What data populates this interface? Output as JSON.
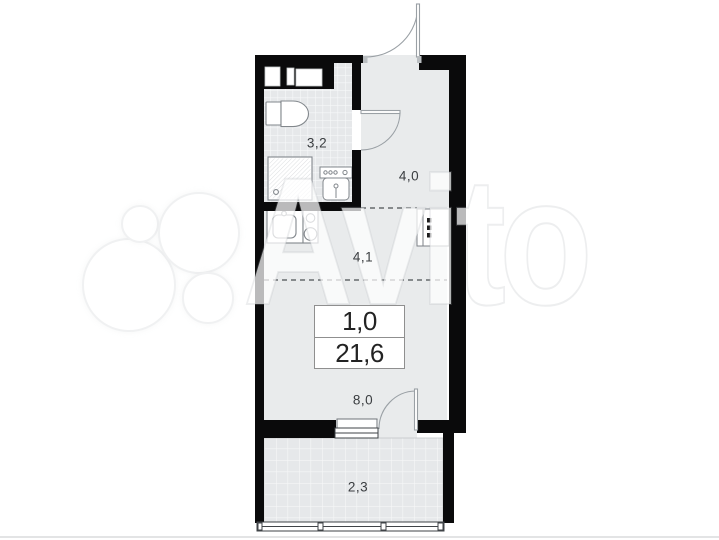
{
  "watermark": {
    "brand": "Avito"
  },
  "floorplan": {
    "labels": {
      "bathroom": "3,2",
      "hall": "4,0",
      "kitchen_zone": "4,1",
      "room": "8,0",
      "balcony": "2,3"
    },
    "info_box": {
      "rooms": "1,0",
      "area": "21,6"
    },
    "colors": {
      "wall": "#0a0a0b",
      "floor": "#e9ebec",
      "tile_grid": "#f7f8f9",
      "fixture_line": "#82878c",
      "door_arc": "#9aa0a5",
      "dashed_divider": "#4c4f52"
    },
    "fixtures": [
      "toilet",
      "shower",
      "washbasin",
      "kitchen-sink",
      "stove",
      "wardrobe",
      "entrance-door",
      "bathroom-door",
      "balcony-door",
      "window",
      "balcony-window",
      "duct-niches"
    ]
  }
}
